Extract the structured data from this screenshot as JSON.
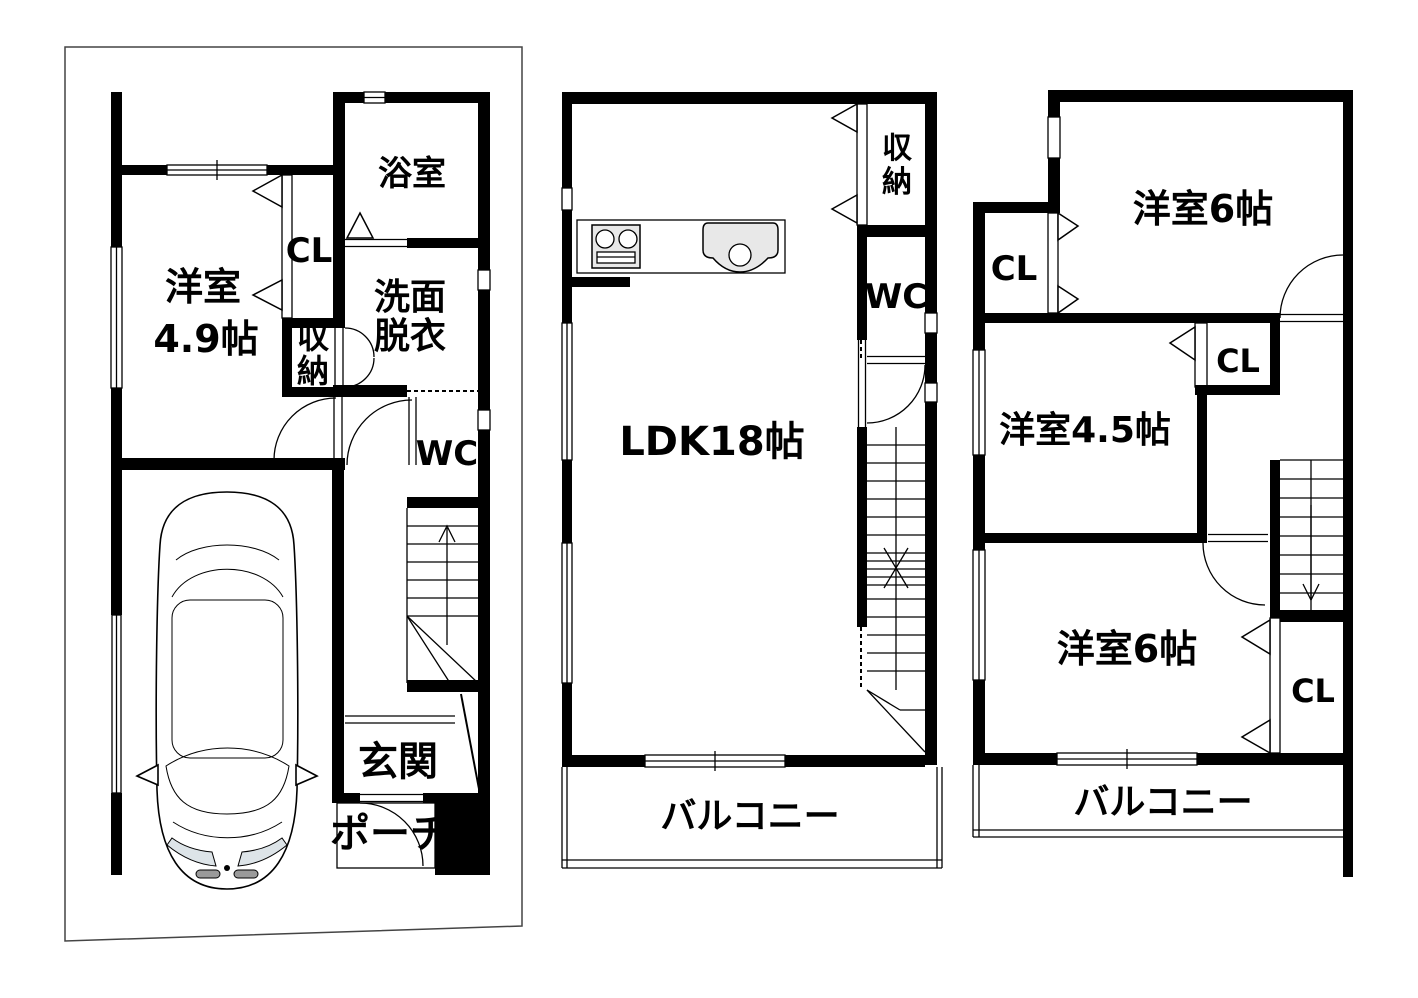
{
  "floors": {
    "f1": {
      "bath": "浴室",
      "closet": "CL",
      "room": "洋室",
      "room_size": "4.9帖",
      "storage_char1": "収",
      "storage_char2": "納",
      "wash_line1": "洗面",
      "wash_line2": "脱衣",
      "wc": "WC",
      "entrance": "玄関",
      "porch": "ポーチ"
    },
    "f2": {
      "storage_char1": "収",
      "storage_char2": "納",
      "wc": "WC",
      "ldk": "LDK18帖",
      "balcony": "バルコニー"
    },
    "f3": {
      "room_top": "洋室6帖",
      "closet1": "CL",
      "room_mid": "洋室4.5帖",
      "closet2": "CL",
      "room_bottom": "洋室6帖",
      "closet3": "CL",
      "balcony": "バルコニー"
    }
  },
  "colors": {
    "wall": "#000000",
    "background": "#ffffff",
    "fixture_fill": "#e8e8e8"
  }
}
